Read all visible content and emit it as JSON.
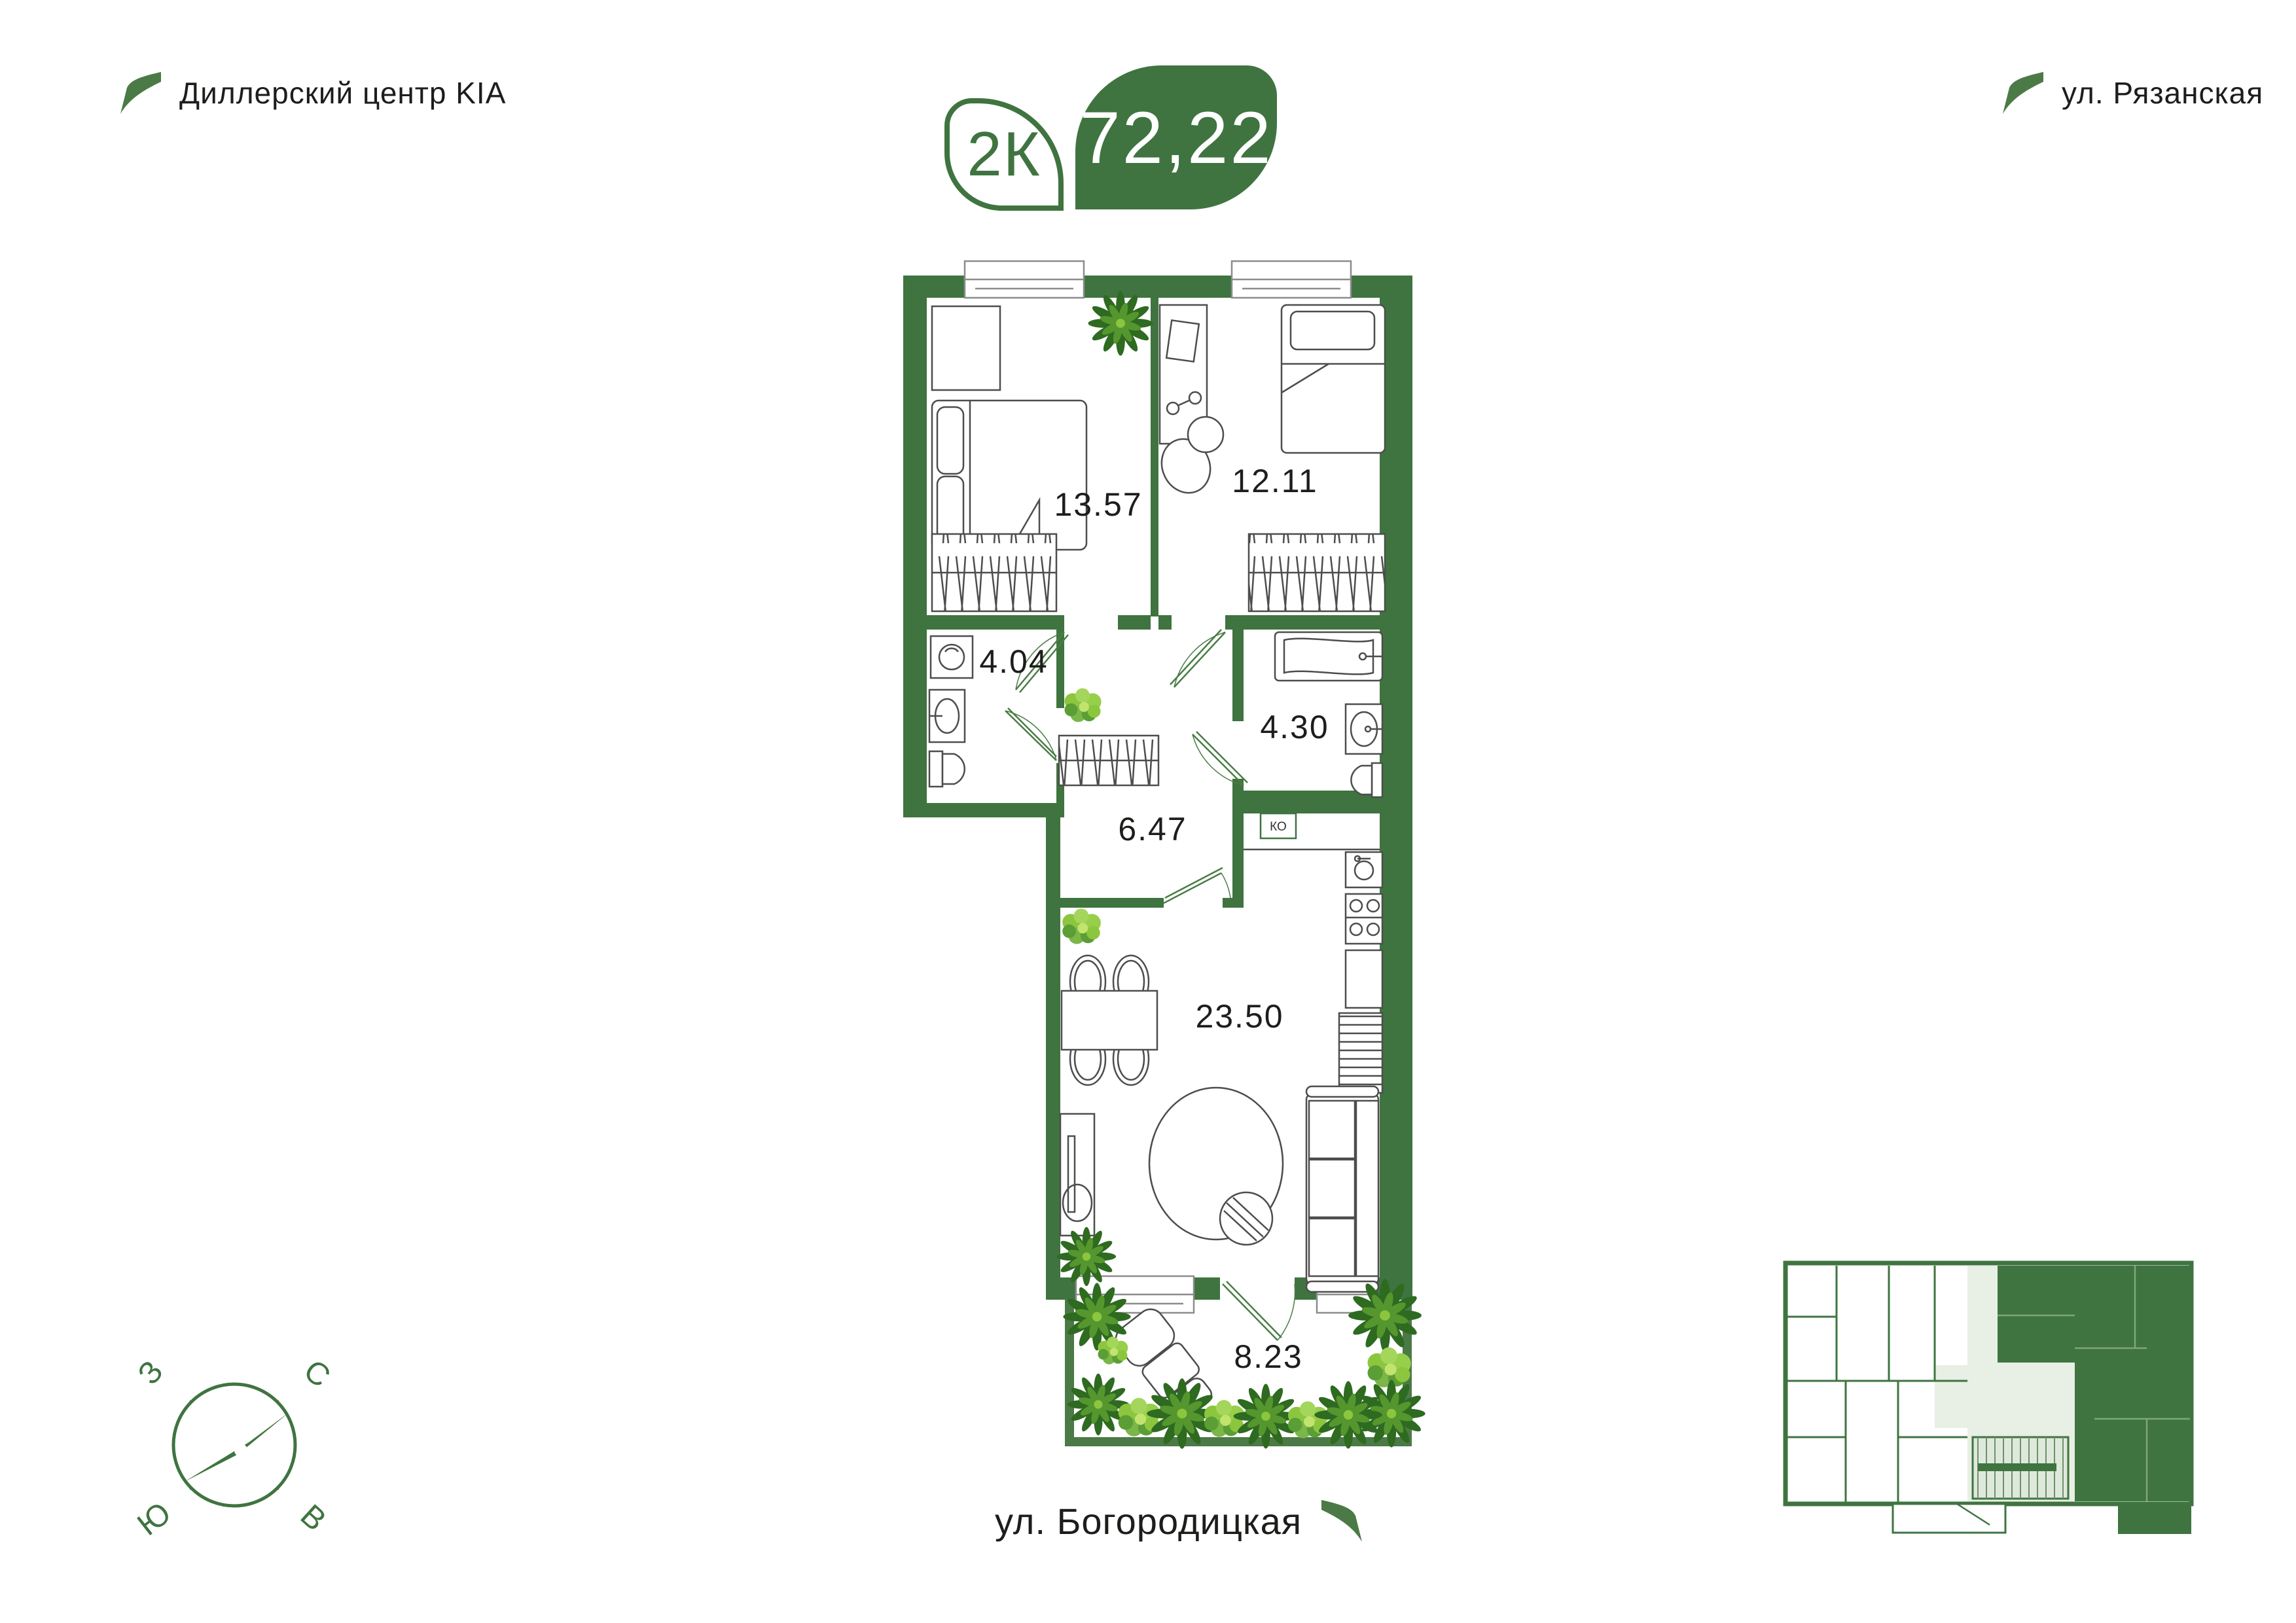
{
  "landmarks": {
    "top_left": "Диллерский центр KIA",
    "top_right": "ул. Рязанская",
    "bottom": "ул. Богородицкая"
  },
  "badge": {
    "rooms": "2К",
    "area": "72,22"
  },
  "plan": {
    "rooms": [
      {
        "id": "bedroom-1",
        "area": "13.57"
      },
      {
        "id": "bedroom-2",
        "area": "12.11"
      },
      {
        "id": "bathroom-1",
        "area": "4.04"
      },
      {
        "id": "bathroom-2",
        "area": "4.30"
      },
      {
        "id": "hallway",
        "area": "6.47"
      },
      {
        "id": "kitchen-living",
        "area": "23.50"
      },
      {
        "id": "terrace",
        "area": "8.23"
      }
    ],
    "closet_label": "КО"
  },
  "compass": {
    "west": "З",
    "north": "С",
    "south": "Ю",
    "east": "В"
  },
  "colors": {
    "accent": "#3F7440",
    "tint": "#E8EFE4",
    "line": "#4d4d4d",
    "text": "#1d1d1b"
  }
}
